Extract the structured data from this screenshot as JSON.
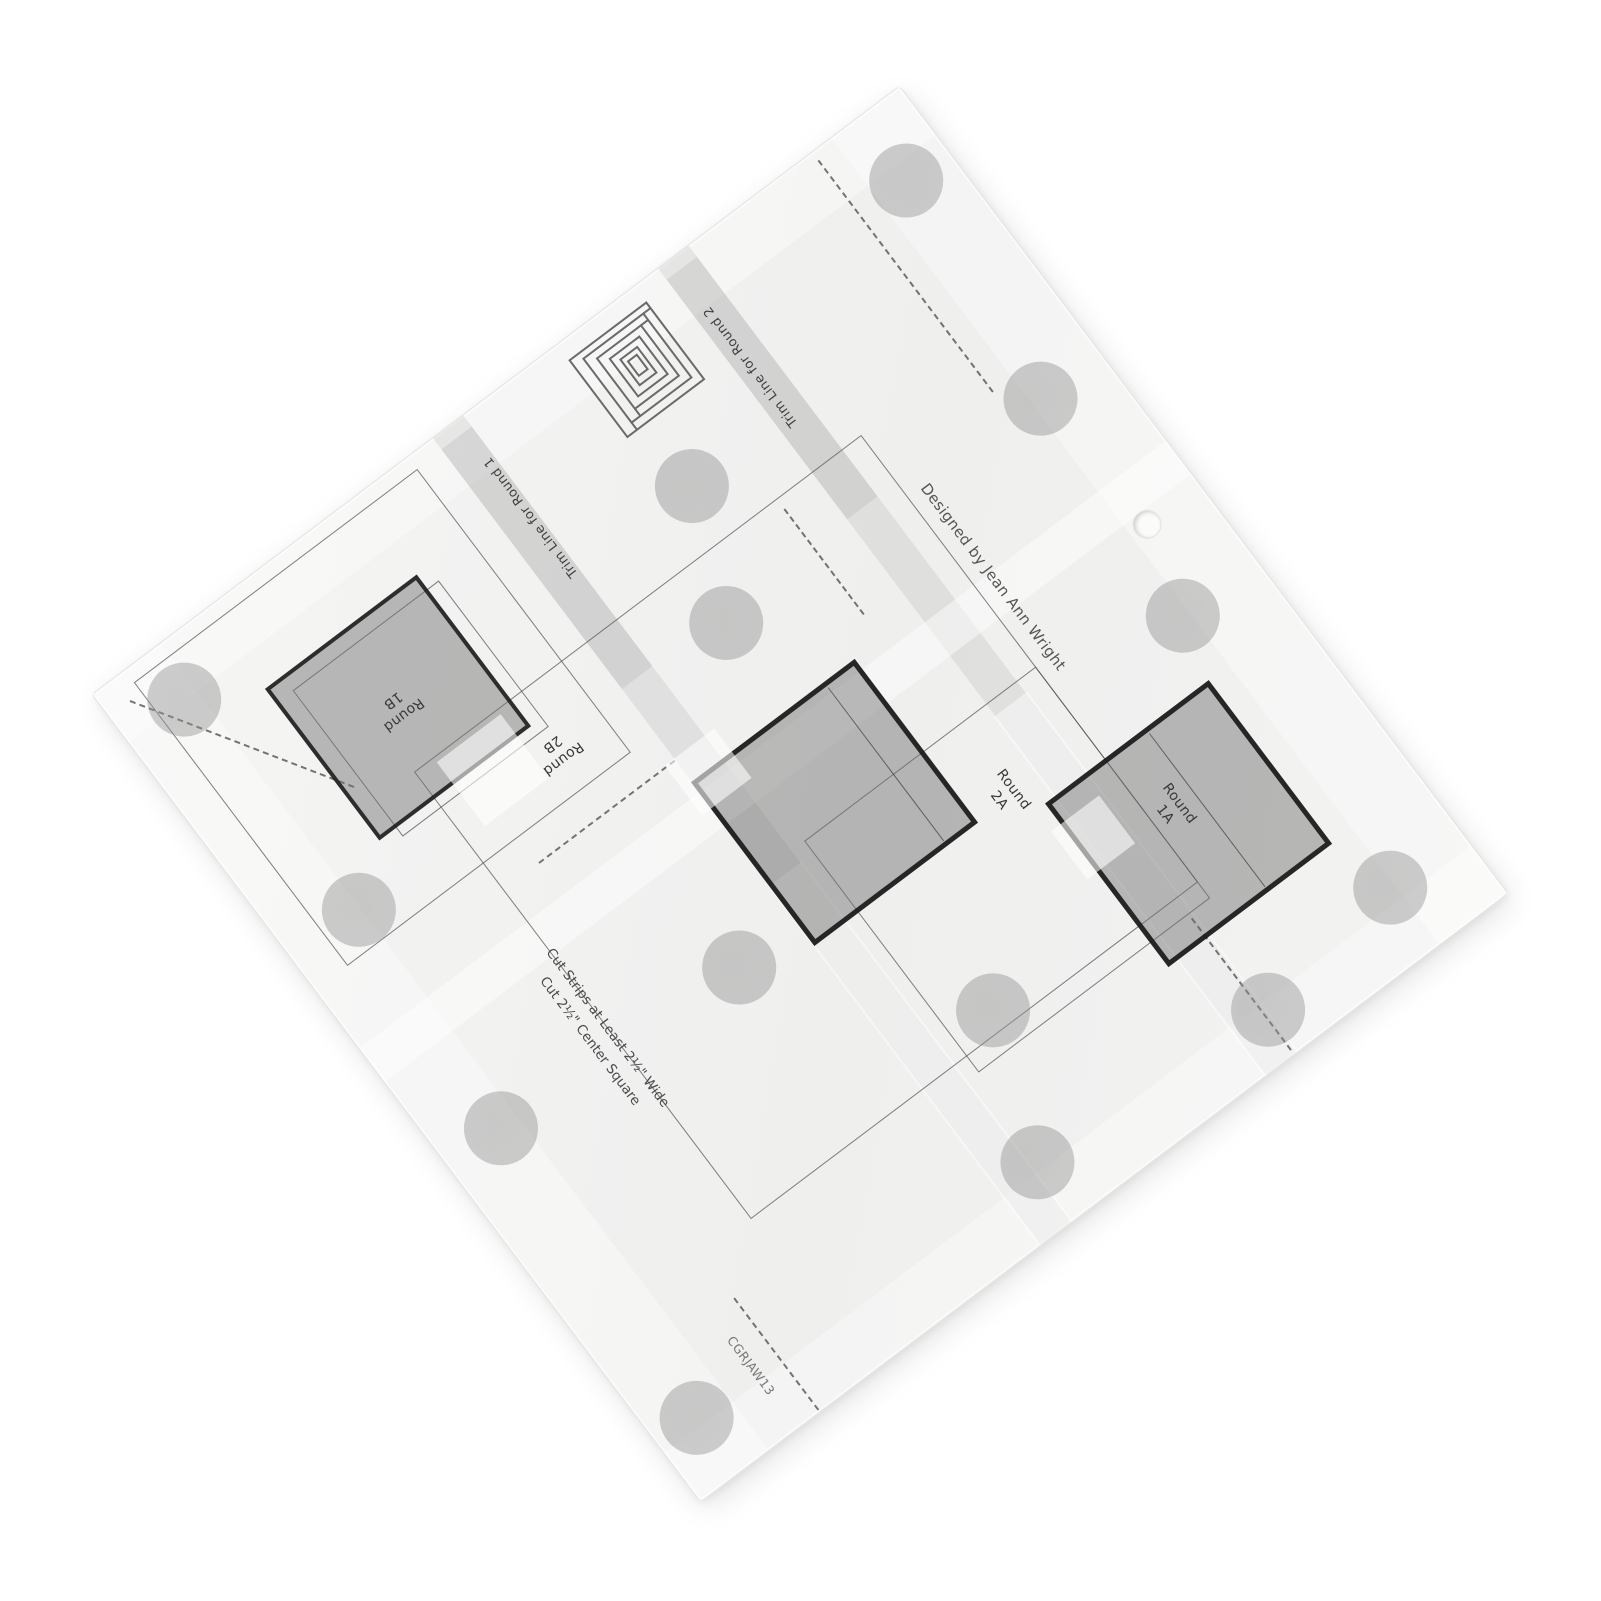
{
  "image_type": "product-photo",
  "subject": "Clear acrylic log cabin quilting trim tool ruler photographed rotated diagonally on white background",
  "scene": {
    "background": "#ffffff"
  },
  "plate": {
    "texts": {
      "trim_line_round_1": "Trim Line for Round 1",
      "trim_line_round_2": "Trim Line for Round 2",
      "designed_by": "Designed by Jean Ann Wright",
      "cut_strips_line_1": "Cut Strips at Least 2½\" Wide",
      "cut_strips_line_2": "Cut 2½\" Center Square",
      "product_code": "CGRJAW13"
    },
    "labels": {
      "round_1b": {
        "line1": "Round",
        "line2": "1B"
      },
      "round_2b": {
        "line1": "Round",
        "line2": "2B"
      },
      "round_2a": {
        "line1": "Round",
        "line2": "2A"
      },
      "round_1a": {
        "line1": "Round",
        "line2": "1A"
      }
    },
    "icon": "log-cabin-block-icon",
    "grip_dot_count": 14,
    "grip_dots": [
      [
        70,
        59
      ],
      [
        959,
        79
      ],
      [
        604,
        194
      ],
      [
        549,
        324
      ],
      [
        935,
        334
      ],
      [
        83,
        332
      ],
      [
        918,
        593
      ],
      [
        65,
        592
      ],
      [
        352,
        607
      ],
      [
        529,
        794
      ],
      [
        920,
        935
      ],
      [
        47,
        941
      ],
      [
        473,
        942
      ],
      [
        749,
        959
      ]
    ],
    "colors": {
      "plate_bg": "#f3f3f2",
      "square_border": "#1f1f1f",
      "square_fill": "#8f8f8f",
      "dot_fill": "#a6a6a6",
      "line_color": "#6b6b6b",
      "text_color": "#3c3c3c"
    }
  }
}
